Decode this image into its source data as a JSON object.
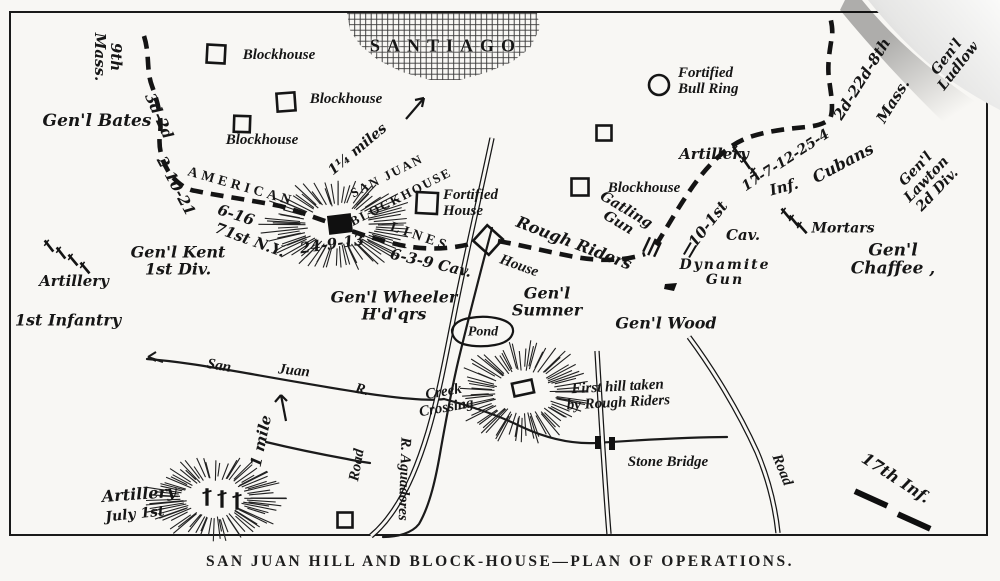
{
  "page": {
    "caption": "SAN JUAN HILL AND BLOCK-HOUSE—PLAN OF OPERATIONS."
  },
  "theme": {
    "ink": "#1a1a1a",
    "paper": "#f8f7f4",
    "curl_shade": "#c9c9c9"
  },
  "map": {
    "labels": {
      "santiago": "SANTIAGO",
      "bh1": "Blockhouse",
      "bh2": "Blockhouse",
      "bh3": "Blockhouse",
      "bh4": "Blockhouse",
      "mass9": "9th\nMass.",
      "bates": "Gen'l Bates",
      "d3d2": "3d-2d",
      "n21021": "2-10-21",
      "american": "AMERICAN",
      "lines": "LINES",
      "sjb1": "SAN JUAN",
      "sjb2": "BLOCKHOUSE",
      "miles": "1¼ miles",
      "n616": "6-16",
      "n71": "71st N.Y.",
      "kent": "Gen'l Kent\n1st Div.",
      "artl": "Artillery",
      "inf1": "1st Infantry",
      "n24913": "24-9-13",
      "n639": "6-3-9 Cav.",
      "forth": "Fortified\nHouse",
      "housed": "House",
      "rough": "Rough Riders",
      "gatling": "Gatling\nGun",
      "bull": "Fortified\nBull Ring",
      "artr": "Artillery",
      "n17712": "17-7-12-25-4",
      "infr": "Inf.",
      "n101": "10-1st",
      "cavr": "Cav.",
      "cubans": "Cubans",
      "m2d22": "2d-22d-8th",
      "massb": "Mass.",
      "ludlow": "Gen'l\nLudlow",
      "lawton": "Gen'l\nLawton\n2d Div.",
      "mortars": "Mortars",
      "dyn": "Dynamite\nGun",
      "chaffee": "Gen'l Chaffee ,",
      "wheeler": "Gen'l Wheeler\nH'd'qrs",
      "sumner": "Gen'l\nSumner",
      "wood": "Gen'l Wood",
      "pond": "Pond",
      "san": "San",
      "juan": "Juan",
      "rr": "R.",
      "mile1": "1 mile",
      "creekx": "Creek\nCrossing",
      "roadc": "Road",
      "agua": "R. Aguadores",
      "fhill": "First hill taken\nby Rough Riders",
      "stoneb": "Stone Bridge",
      "roadr": "Road",
      "i17": "17th Inf.",
      "artj": "Artillery",
      "july": "July 1st"
    }
  }
}
